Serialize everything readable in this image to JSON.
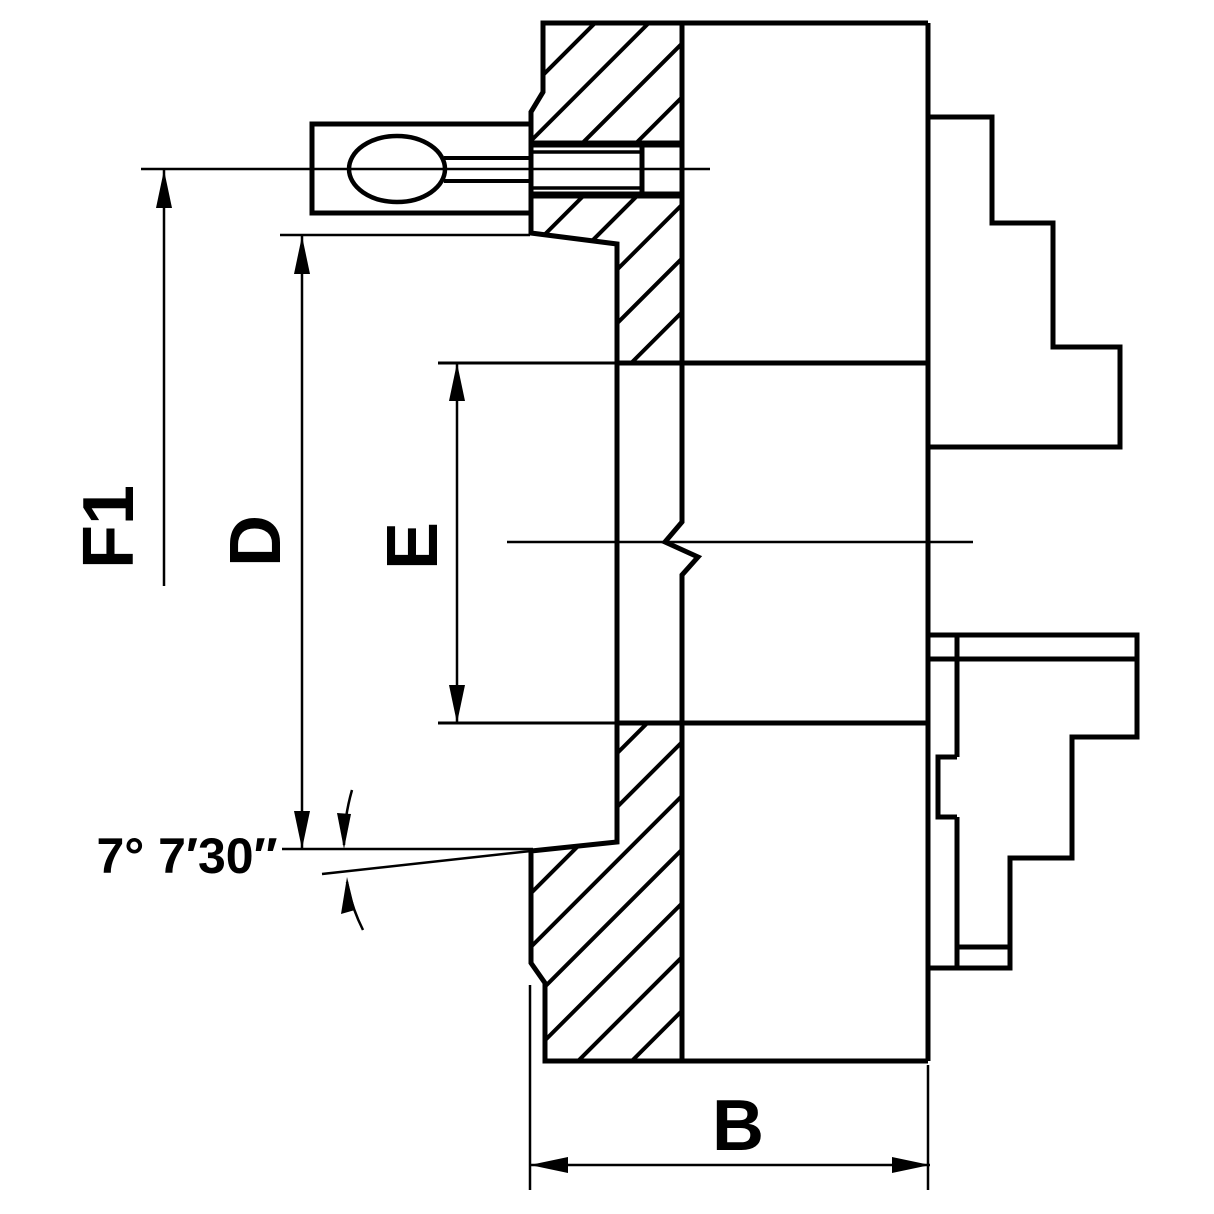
{
  "drawing": {
    "title": "lathe-chuck-cross-section-technical-drawing",
    "background_color": "#ffffff",
    "line_color": "#000000",
    "dimensions": {
      "f1_label": "F1",
      "d_label": "D",
      "e_label": "E",
      "b_label": "B",
      "taper_angle_label": "7° 7′30″"
    }
  }
}
